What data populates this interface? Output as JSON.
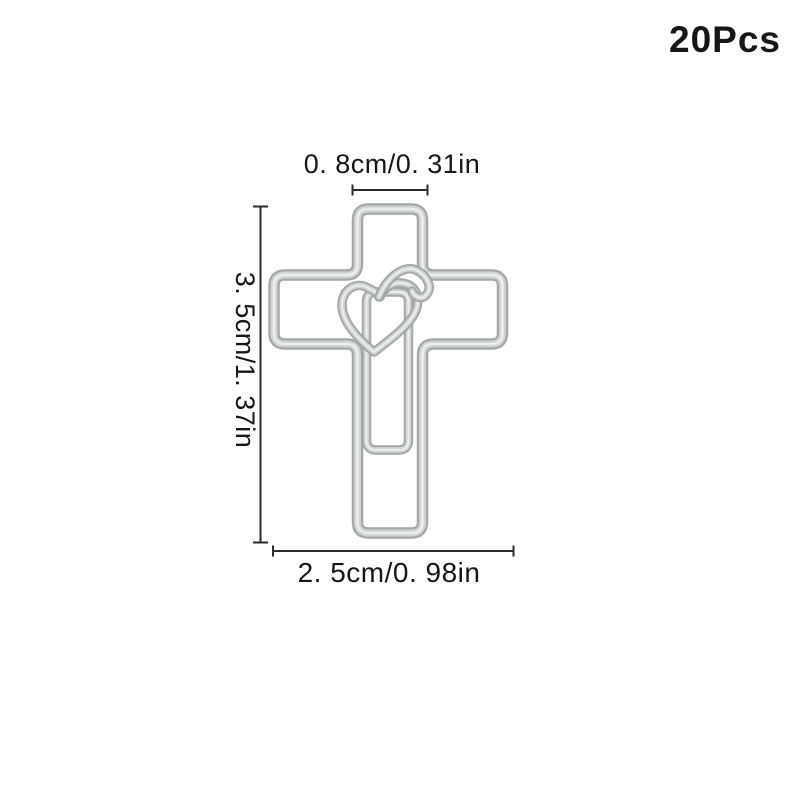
{
  "badge": {
    "text": "20Pcs"
  },
  "product": {
    "name": "cross-heart-paper-clip",
    "description": "silver wire paper clip shaped as a latin cross with an inner loop and a heart at the center",
    "quantity_label": "20Pcs"
  },
  "dimensions": {
    "top": {
      "label": "0. 8cm/0. 31in",
      "measures": "width of vertical bar"
    },
    "left": {
      "label": "3. 5cm/1. 37in",
      "measures": "overall height"
    },
    "bottom": {
      "label": "2. 5cm/0. 98in",
      "measures": "overall width"
    }
  },
  "colors": {
    "background": "#ffffff",
    "text": "#161616",
    "dim-line": "#2b2b2b",
    "wire-edge": "#a2a8a5",
    "wire-mid": "#d0d4d1",
    "wire-highlight": "#eceeec"
  }
}
